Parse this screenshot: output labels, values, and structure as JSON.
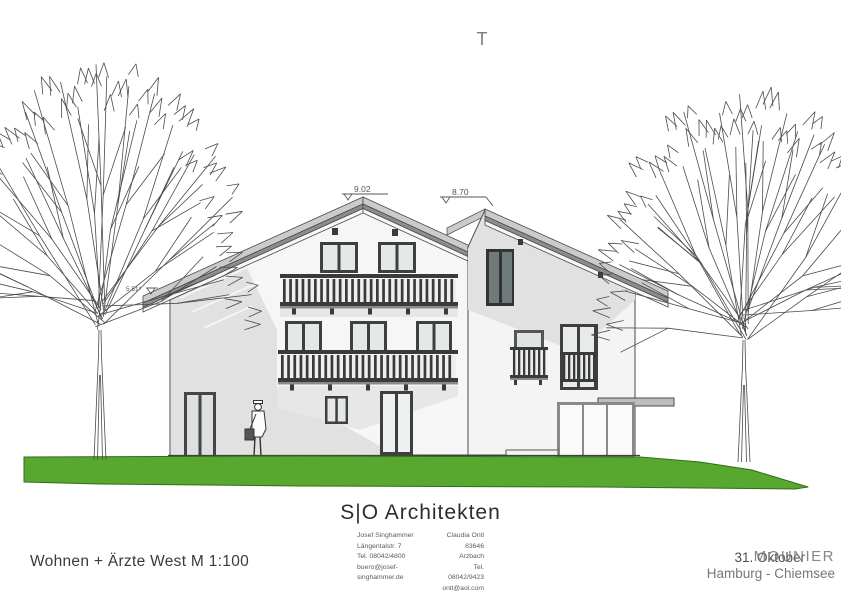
{
  "sheet": {
    "crop_mark": "T",
    "title": "Wohnen + Ärzte West M 1:100",
    "levels": {
      "main_ridge": "9.02",
      "side_ridge": "8.70",
      "left_eave": "5.51⁵"
    }
  },
  "firm": {
    "name": "S|O Architekten",
    "contacts": [
      {
        "name": "Josef Singhammer",
        "address": "Längentalstr. 7",
        "phone": "Tel. 08042/4800",
        "email": "buero@josef-singhammer.de"
      },
      {
        "name": "Claudia Ontl",
        "address": "83646 Arzbach",
        "phone": "Tel. 08042/9423",
        "email": "ontl@aol.com"
      }
    ]
  },
  "stamp": {
    "date": "31. Oktober",
    "watermark": "MOUNIER",
    "location": "Hamburg - Chiemsee"
  },
  "colors": {
    "grass": "#58a72f",
    "roof_light": "#cbcbcb",
    "roof_dark": "#8d8d8d",
    "shadow": "#e1e1e1",
    "line": "#3f3f3f"
  }
}
